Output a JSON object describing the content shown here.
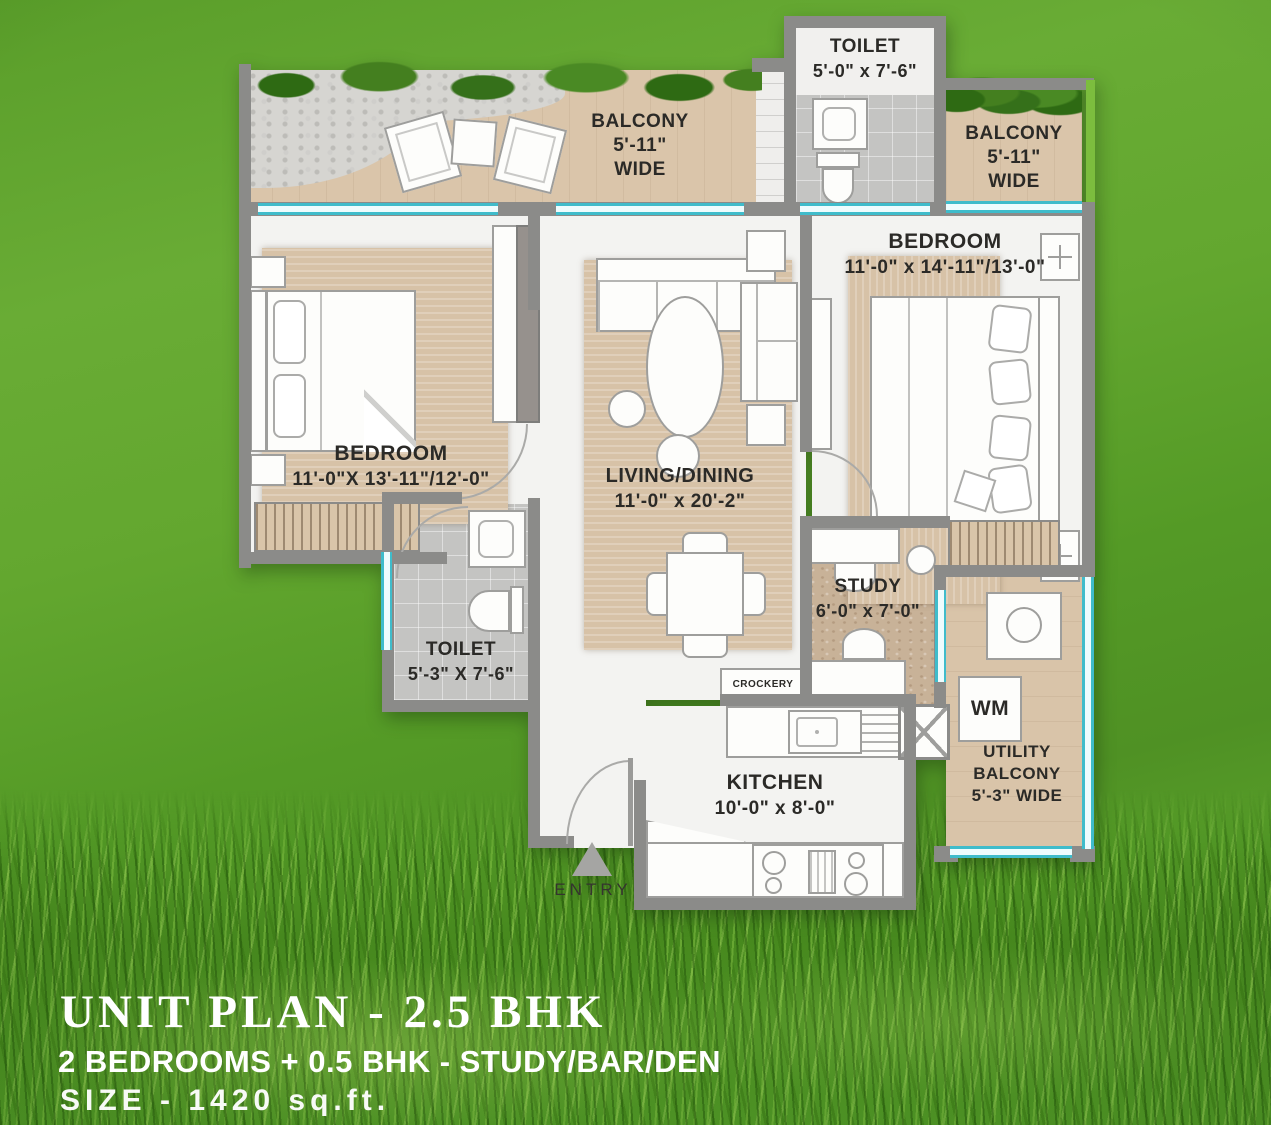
{
  "footer": {
    "title": "UNIT PLAN - 2.5 BHK",
    "subtitle": "2 BEDROOMS + 0.5 BHK - STUDY/BAR/DEN",
    "size": "SIZE - 1420 sq.ft."
  },
  "rooms": {
    "toilet_top": {
      "name": "TOILET",
      "dims": "5'-0\" x 7'-6\""
    },
    "balcony_left": {
      "label": "BALCONY\n5'-11\"\nWIDE"
    },
    "balcony_right": {
      "label": "BALCONY\n5'-11\"\nWIDE"
    },
    "bedroom_right": {
      "name": "BEDROOM",
      "dims": "11'-0\" x 14'-11\"/13'-0\""
    },
    "bedroom_left": {
      "name": "BEDROOM",
      "dims": "11'-0\"X 13'-11\"/12'-0\""
    },
    "living": {
      "name": "LIVING/DINING",
      "dims": "11'-0\" x 20'-2\""
    },
    "toilet_bottom": {
      "name": "TOILET",
      "dims": "5'-3\" X 7'-6\""
    },
    "study": {
      "name": "STUDY",
      "dims": "6'-0\" x 7'-0\""
    },
    "kitchen": {
      "name": "KITCHEN",
      "dims": "10'-0\" x 8'-0\""
    },
    "crockery": {
      "label": "CROCKERY"
    },
    "wm": {
      "label": "WM"
    },
    "utility": {
      "label": "UTILITY\nBALCONY\n5'-3\" WIDE"
    },
    "entry": {
      "label": "ENTRY"
    }
  },
  "colors": {
    "wall": "#8b8b89",
    "window_teal": "#3fbccb",
    "wood_floor": "#dac5aa",
    "greenery": "#3e7a1e",
    "lawn_green": "#5fa42d",
    "label_text": "#2b2a27",
    "footer_text": "#ffffff",
    "right_edge_green": "#7cbd3e"
  }
}
